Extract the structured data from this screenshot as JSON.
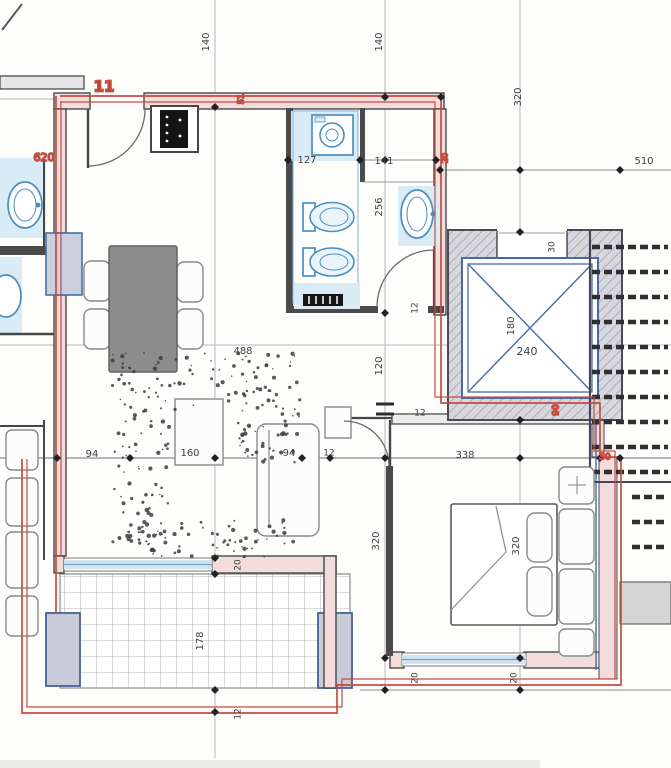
{
  "plan": {
    "unit_label": "11",
    "drawing_type": "architectural floor plan",
    "colors": {
      "boundary_red": "#c44d42",
      "text_red": "#c0392b",
      "text_dark": "#3f3f3f",
      "fixture_blue": "#4a8fc0",
      "elevator_blue": "#4a6aa5",
      "window_blue": "#cfe3f0",
      "wall_pink": "#f3dcdc",
      "hatch_gray": "#d7d7dd"
    },
    "elevator": {
      "width_label": "180",
      "depth_label": "240"
    },
    "dimension_labels": [
      {
        "text": "11",
        "x": 104,
        "y": 87,
        "rot": 0,
        "color": "red",
        "size": 15,
        "bold": true
      },
      {
        "text": "140",
        "x": 206,
        "y": 42,
        "rot": -90,
        "color": "dark",
        "size": 10
      },
      {
        "text": "140",
        "x": 379,
        "y": 42,
        "rot": -90,
        "color": "dark",
        "size": 10
      },
      {
        "text": "320",
        "x": 518,
        "y": 97,
        "rot": -90,
        "color": "dark",
        "size": 10
      },
      {
        "text": "510",
        "x": 644,
        "y": 161,
        "rot": 0,
        "color": "dark",
        "size": 10
      },
      {
        "text": "620",
        "x": 44,
        "y": 158,
        "rot": 0,
        "color": "red",
        "size": 11
      },
      {
        "text": "51",
        "x": 241,
        "y": 99,
        "rot": -90,
        "color": "red",
        "size": 8
      },
      {
        "text": "20",
        "x": 445,
        "y": 158,
        "rot": -90,
        "color": "red",
        "size": 8
      },
      {
        "text": "127",
        "x": 307,
        "y": 160,
        "rot": 0,
        "color": "dark",
        "size": 10
      },
      {
        "text": "141",
        "x": 384,
        "y": 161,
        "rot": 0,
        "color": "dark",
        "size": 10
      },
      {
        "text": "256",
        "x": 379,
        "y": 207,
        "rot": -90,
        "color": "dark",
        "size": 10
      },
      {
        "text": "30",
        "x": 552,
        "y": 247,
        "rot": -90,
        "color": "dark",
        "size": 9
      },
      {
        "text": "180",
        "x": 511,
        "y": 326,
        "rot": -90,
        "color": "dark",
        "size": 10
      },
      {
        "text": "240",
        "x": 527,
        "y": 352,
        "rot": 0,
        "color": "dark",
        "size": 11
      },
      {
        "text": "90",
        "x": 556,
        "y": 410,
        "rot": -90,
        "color": "red",
        "size": 9
      },
      {
        "text": "12",
        "x": 415,
        "y": 308,
        "rot": -90,
        "color": "dark",
        "size": 9
      },
      {
        "text": "120",
        "x": 379,
        "y": 366,
        "rot": -90,
        "color": "dark",
        "size": 10
      },
      {
        "text": "488",
        "x": 243,
        "y": 351,
        "rot": 0,
        "color": "dark",
        "size": 10
      },
      {
        "text": "12",
        "x": 420,
        "y": 413,
        "rot": 0,
        "color": "dark",
        "size": 9
      },
      {
        "text": "94",
        "x": 92,
        "y": 454,
        "rot": 0,
        "color": "dark",
        "size": 10
      },
      {
        "text": "160",
        "x": 190,
        "y": 453,
        "rot": 0,
        "color": "dark",
        "size": 10
      },
      {
        "text": "94",
        "x": 289,
        "y": 453,
        "rot": 0,
        "color": "dark",
        "size": 10
      },
      {
        "text": "12",
        "x": 329,
        "y": 453,
        "rot": 0,
        "color": "dark",
        "size": 9
      },
      {
        "text": "338",
        "x": 465,
        "y": 455,
        "rot": 0,
        "color": "dark",
        "size": 10
      },
      {
        "text": "30",
        "x": 605,
        "y": 457,
        "rot": 0,
        "color": "red",
        "size": 9
      },
      {
        "text": "320",
        "x": 376,
        "y": 541,
        "rot": -90,
        "color": "dark",
        "size": 10
      },
      {
        "text": "320",
        "x": 516,
        "y": 546,
        "rot": -90,
        "color": "dark",
        "size": 10
      },
      {
        "text": "20",
        "x": 238,
        "y": 565,
        "rot": -90,
        "color": "dark",
        "size": 9
      },
      {
        "text": "178",
        "x": 200,
        "y": 641,
        "rot": -90,
        "color": "dark",
        "size": 10
      },
      {
        "text": "12",
        "x": 238,
        "y": 714,
        "rot": -90,
        "color": "dark",
        "size": 9
      },
      {
        "text": "20",
        "x": 415,
        "y": 678,
        "rot": -90,
        "color": "dark",
        "size": 9
      },
      {
        "text": "20",
        "x": 514,
        "y": 678,
        "rot": -90,
        "color": "dark",
        "size": 9
      }
    ]
  }
}
